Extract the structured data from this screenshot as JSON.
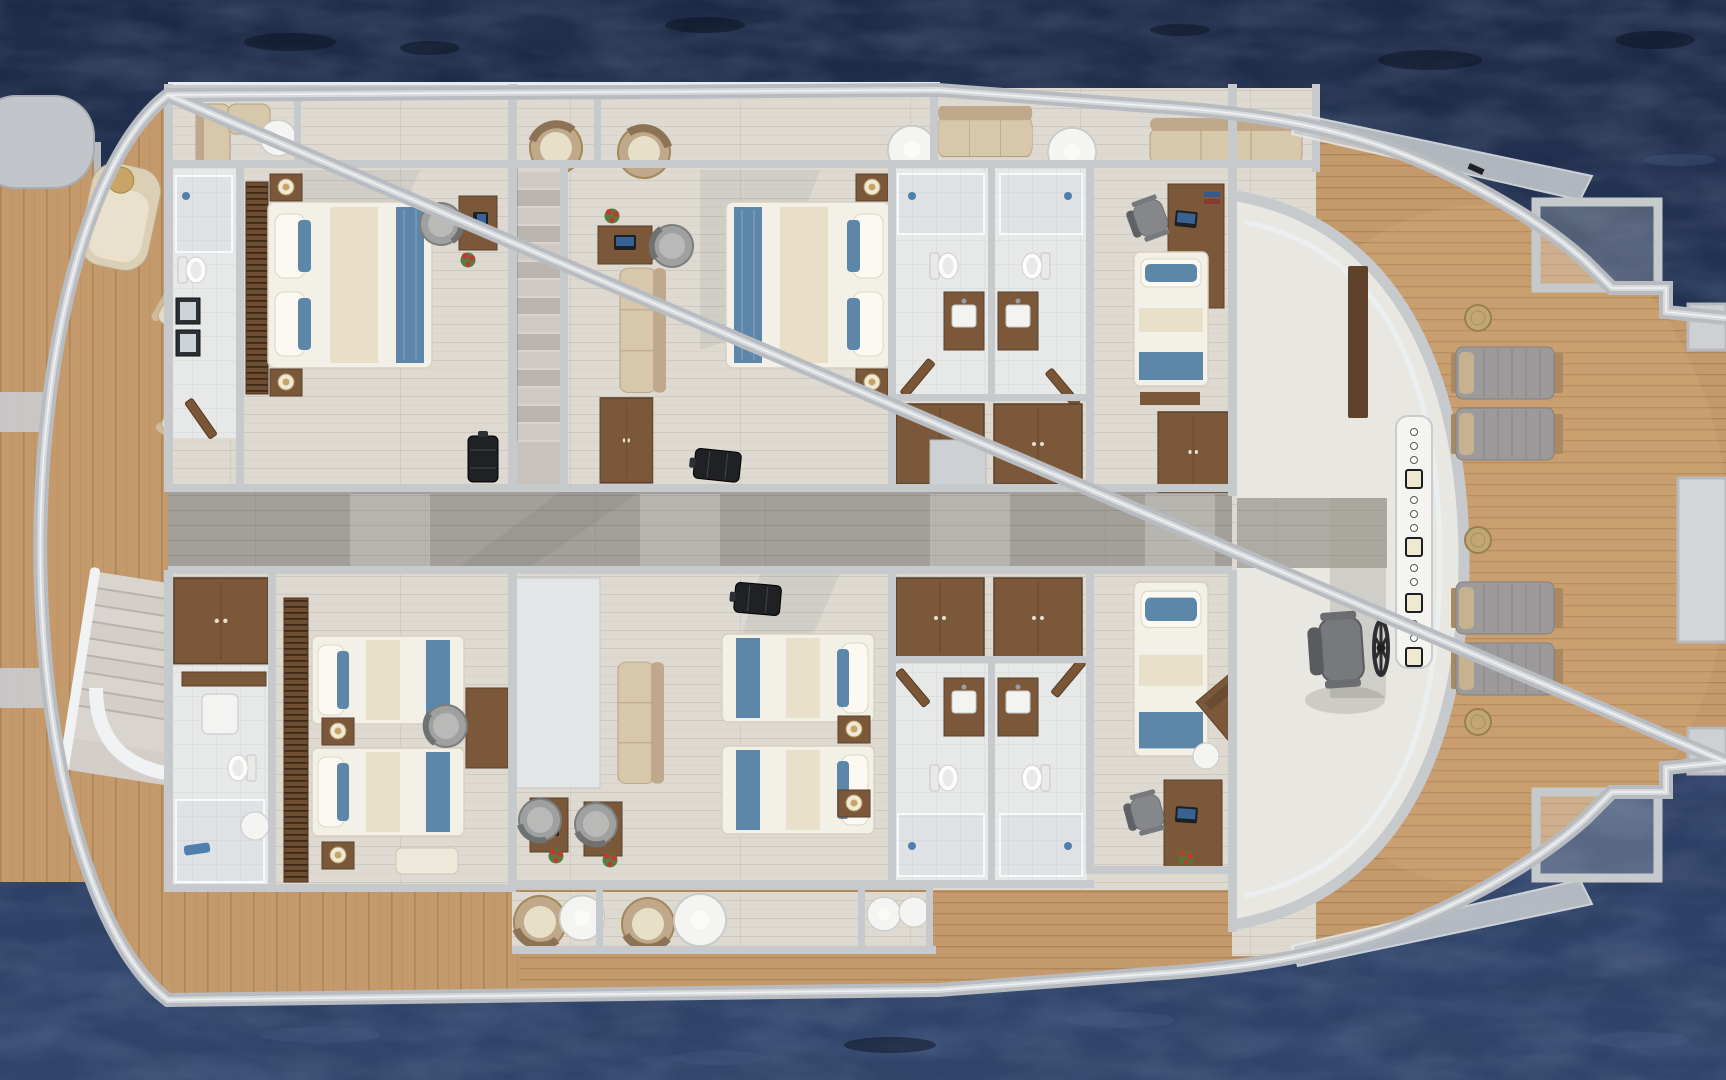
{
  "scene": {
    "title": "Yacht guest deck floor plan - top-down 3D render",
    "environment": "yacht hull floating on dark blue open water",
    "view": "top-down orthographic",
    "orientation": {
      "bow": "right",
      "stern": "left"
    }
  },
  "colors": {
    "water_deep": "#1a2643",
    "water_mid": "#24345a",
    "water_light": "#31456f",
    "ripple_dark": "#0a111f",
    "ripple_light": "#4c6189",
    "hull_band": "#b8bcc1",
    "hull_band_light": "#d7dadd",
    "hull_trim": "#f0f2f3",
    "wood": "#c49a6c",
    "wood_light": "#d4ab7d",
    "wood_line": "#9e7748",
    "floor_light": "#dedad2",
    "floor_line": "#b8b3a8",
    "floor_white": "#efeeea",
    "corridor": "#a3a099",
    "corridor_line": "#8a8780",
    "tile": "#e7e8e8",
    "tile_line": "#c9ccce",
    "wall": "#c7cacd",
    "wall_light": "#e9ebec",
    "wall_dark": "#a6aaae",
    "glass": "#d8e0e4",
    "furn_wood": "#7b583a",
    "furn_wood_dark": "#59402a",
    "bed_white": "#f3f0e7",
    "bed_cream": "#e6dcc2",
    "bed_blue": "#5d87a9",
    "pillow_white": "#fbf9f2",
    "sofa_beige": "#d7c7ab",
    "sofa_beige_dark": "#bfa98a",
    "cushion_brown": "#8d7356",
    "lounger_gray": "#9c9a9a",
    "lounger_seam": "#7f7d7c",
    "lounger_base": "#a9895f",
    "stool_tan": "#c2a775",
    "chair_gray": "#85878a",
    "chair_gray_dark": "#5f6164",
    "marble": "#d9d5ce",
    "marble_dark": "#b7b3ac",
    "lamp_gold": "#c8a566",
    "black_item": "#1f2124",
    "flower_red": "#c13a2f",
    "flower_green": "#4c7a3b",
    "white_disc": "#f4f4f2",
    "shower_blue": "#4f7fae"
  },
  "rooms": [
    {
      "id": "swim-platform",
      "name": "Stern swim platform"
    },
    {
      "id": "aft-deck",
      "name": "Aft deck with round dining table, chairs and chaise lounge"
    },
    {
      "id": "aft-stairs",
      "name": "Exterior aft staircase"
    },
    {
      "id": "terrace-top",
      "name": "Port side balcony terrace with sofas and round chairs"
    },
    {
      "id": "bathroom-port-aft",
      "name": "Port aft guest bathroom"
    },
    {
      "id": "cabin-port-aft",
      "name": "Port aft double guest cabin"
    },
    {
      "id": "stairwell",
      "name": "Interior marble staircase"
    },
    {
      "id": "cabin-port-mid",
      "name": "Port midship double guest cabin"
    },
    {
      "id": "bathrooms-port-fwd",
      "name": "Forward twin bathrooms, port pair"
    },
    {
      "id": "cabin-port-fwd",
      "name": "Forward port single cabin with desk"
    },
    {
      "id": "corridor",
      "name": "Central corridor"
    },
    {
      "id": "bathroom-stbd-aft",
      "name": "Starboard aft guest bathroom"
    },
    {
      "id": "cabin-stbd-aft",
      "name": "Starboard aft twin guest cabin"
    },
    {
      "id": "cabin-stbd-mid",
      "name": "Starboard midship twin guest cabin"
    },
    {
      "id": "bathrooms-stbd-fwd",
      "name": "Forward twin bathrooms, starboard pair"
    },
    {
      "id": "cabin-stbd-fwd",
      "name": "Forward starboard single cabin with desk"
    },
    {
      "id": "terrace-bottom",
      "name": "Starboard side balcony terrace"
    },
    {
      "id": "wheelhouse",
      "name": "Wheelhouse bridge with helm wheel, chair and console"
    },
    {
      "id": "bow-deck",
      "name": "Bow teak sun deck with loungers and stools"
    }
  ],
  "furniture": {
    "double_beds": 2,
    "twin_beds": 4,
    "single_beds": 2,
    "toilets": 6,
    "vanity_sinks": 7,
    "showers": 6,
    "wardrobes": 7,
    "desks": 8,
    "wicker_desk_chairs": 4,
    "office_chairs": 2,
    "sofas": 5,
    "rattan_armchairs": 4,
    "round_side_tables": 6,
    "dining_table": 1,
    "dining_chairs": 4,
    "chaise_lounges": 1,
    "sun_loungers": 4,
    "deck_stools": 3,
    "suitcases": 3,
    "staircases": 2,
    "helm_wheel": 1,
    "helm_chair": 1,
    "flower_pots": 6
  }
}
